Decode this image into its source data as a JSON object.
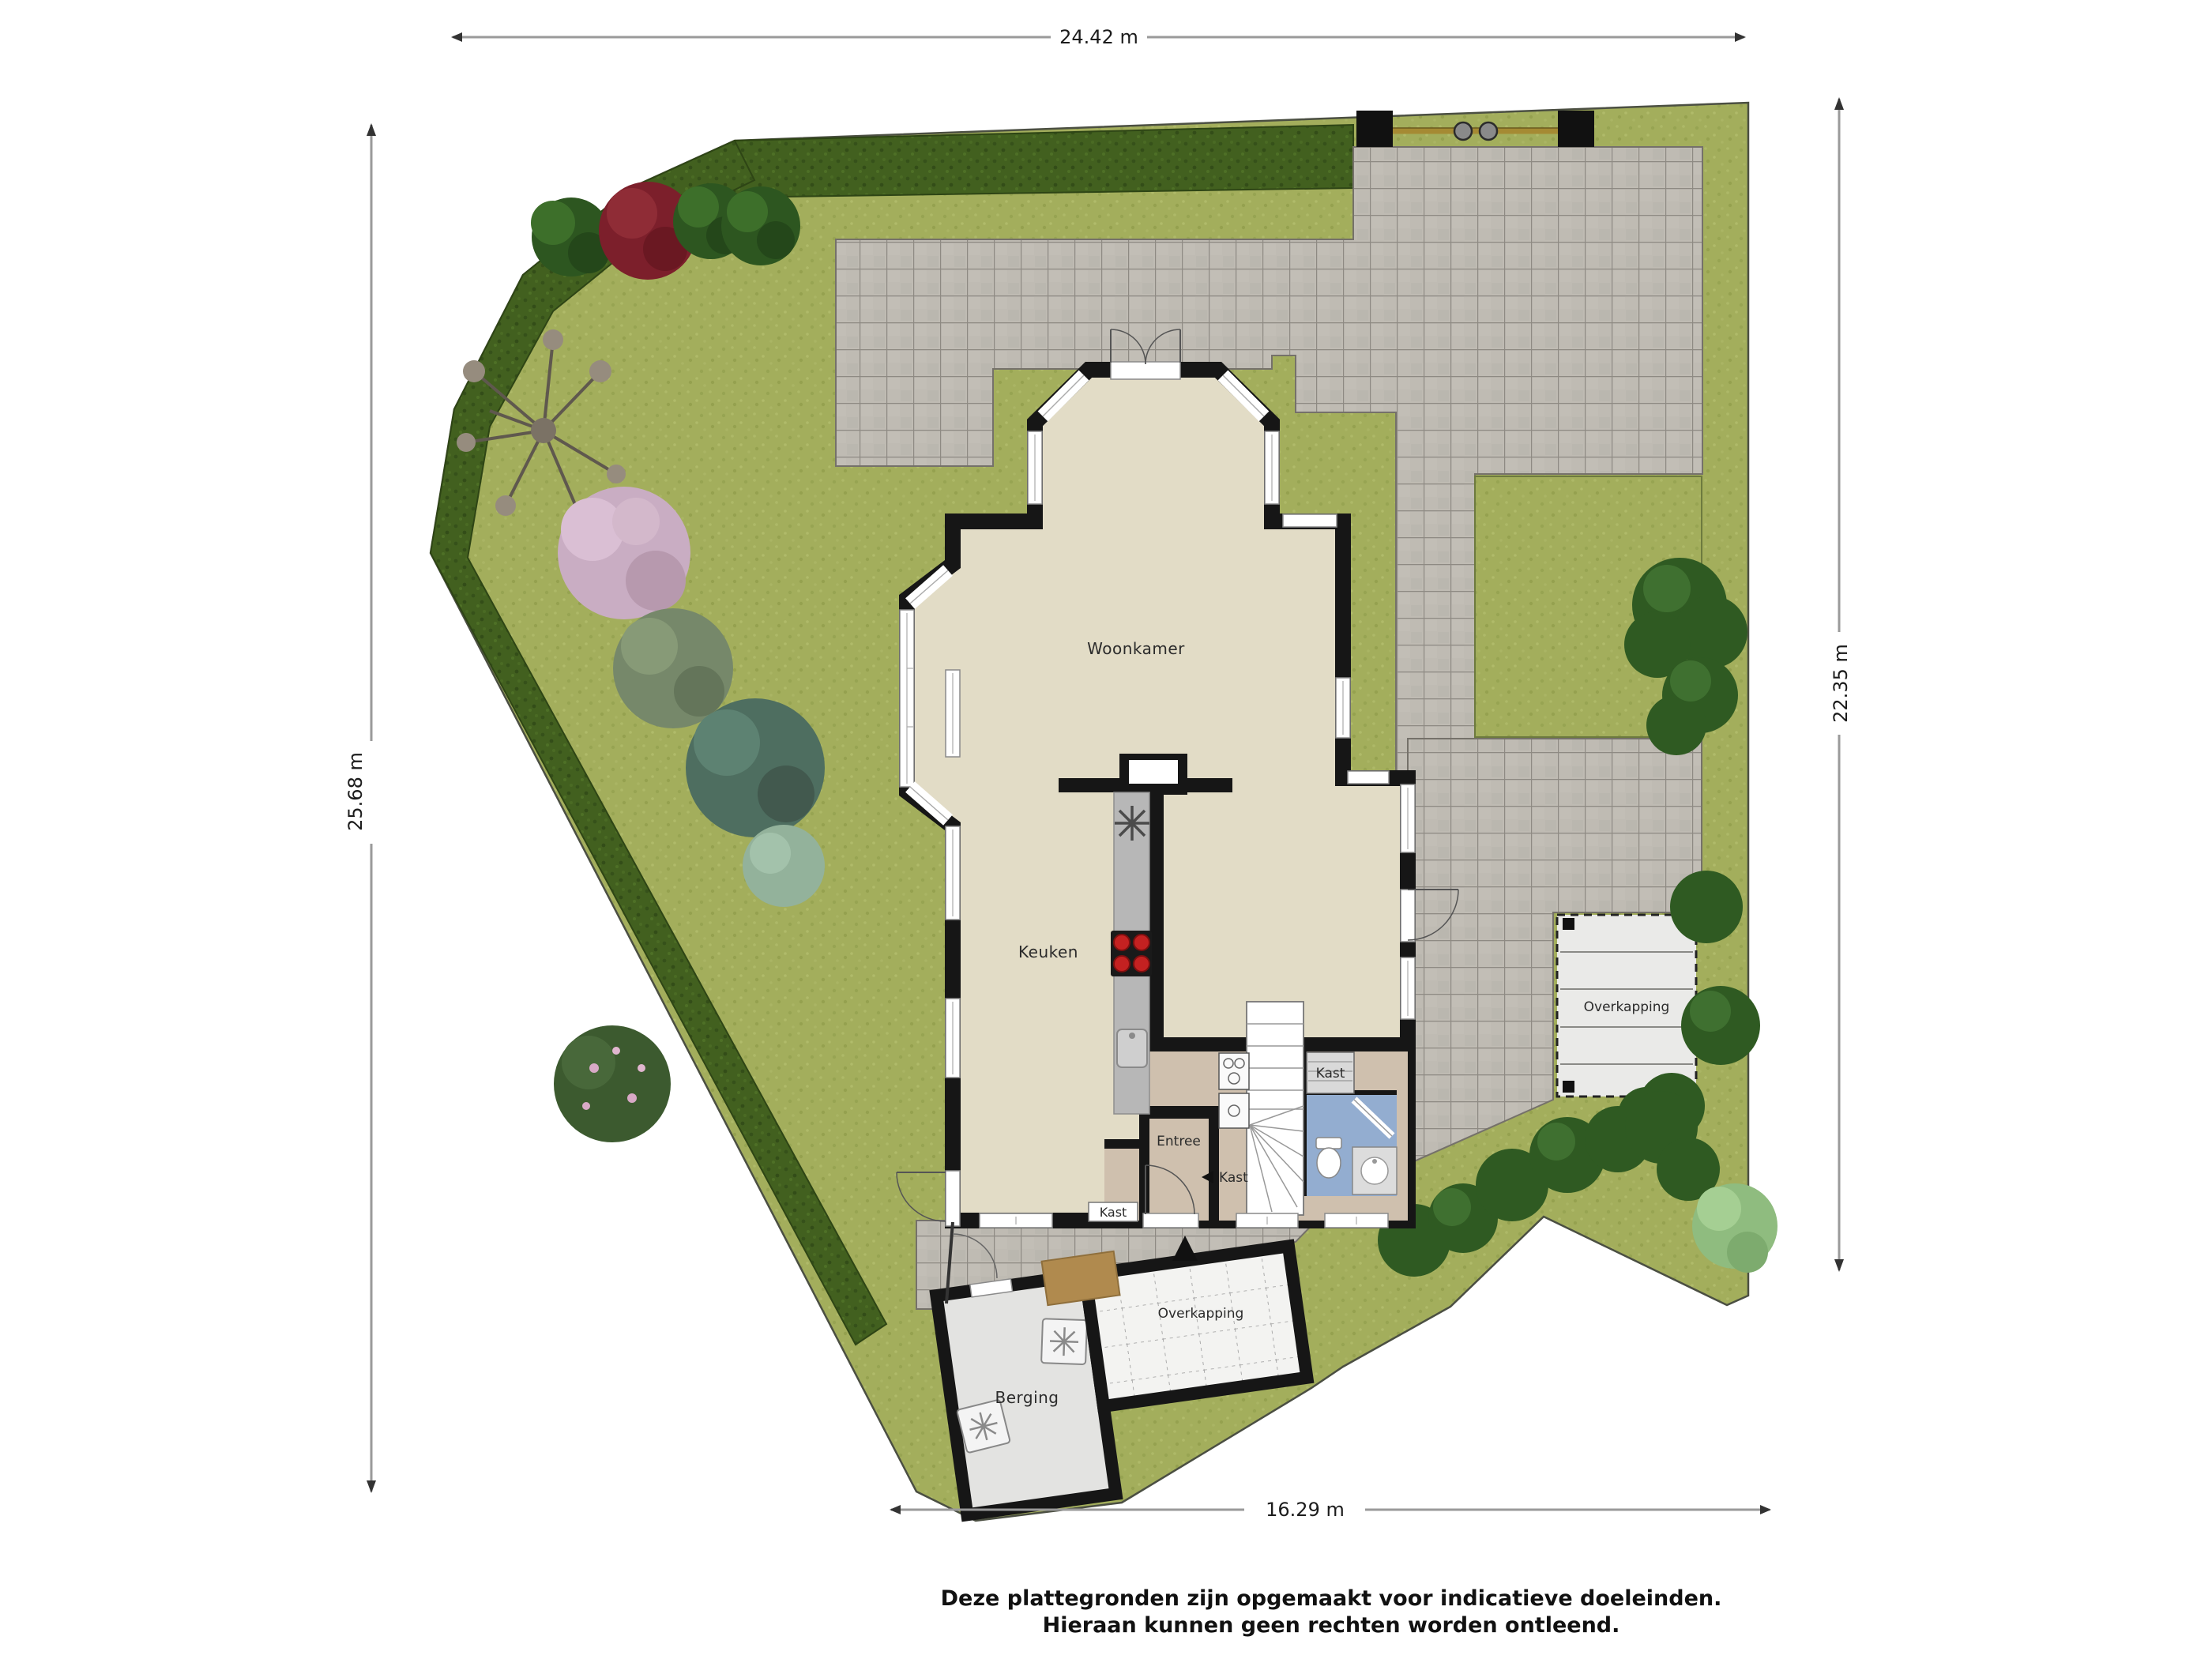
{
  "dimensions": {
    "top": "24.42 m",
    "left": "25.68 m",
    "right": "22.35 m",
    "bottom": "16.29 m"
  },
  "labels": {
    "woonkamer": "Woonkamer",
    "keuken": "Keuken",
    "entree": "Entree",
    "kast": "Kast",
    "overkapping": "Overkapping",
    "berging": "Berging"
  },
  "disclaimer": {
    "line1": "Deze plattegronden zijn opgemaakt voor indicatieve doeleinden.",
    "line2": "Hieraan kunnen geen rechten worden ontleend."
  },
  "colors": {
    "grass": "#a3ae5c",
    "hedge": "#42601f",
    "paving": "#bfbbb3",
    "grout": "#8e8a83",
    "floor": "#e2dcc6",
    "hall_floor": "#cfc0ae",
    "bath_floor": "#93add0",
    "wall": "#161616",
    "counter": "#b7b7b7",
    "burner": "#c42121",
    "shed_floor": "#e3e3e1",
    "canopy_floor": "#eaeae8",
    "canopy_tile": "#f3f3f1",
    "doormat": "#b08a4e",
    "gate_bar": "#a58a33"
  }
}
